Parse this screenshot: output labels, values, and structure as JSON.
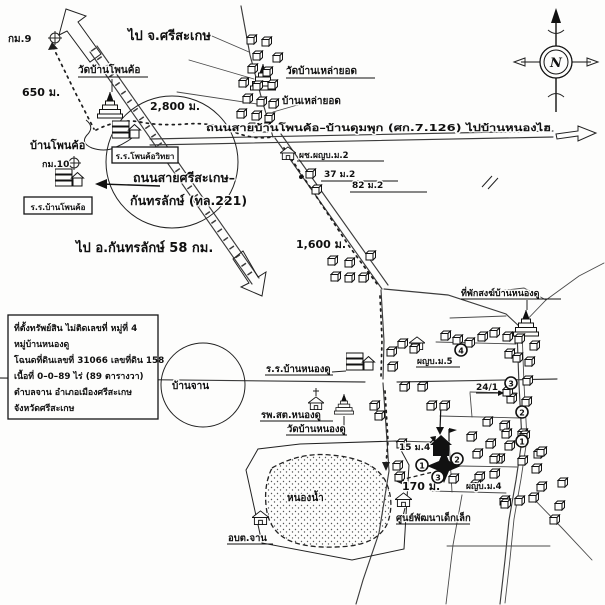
{
  "labels": {
    "to_sisaket": "ไป จ.ศรีสะเกษ",
    "km9": "กม.9",
    "dist_650": "650 ม.",
    "wat_phonkho": "วัดบ้านโพนค้อ",
    "ban_phonkho": "บ้านโพนค้อ",
    "dist_2800": "2,800 ม.",
    "school_phonkho_wittaya": "ร.ร.โพนค้อวิทยา",
    "km10": "กม.10",
    "school_ban_phonkho": "ร.ร.บ้านโพนค้อ",
    "road_221_line1": "ถนนสายศรีสะเกษ–",
    "road_221_line2": "กันทรลักษ์ (ทล.221)",
    "to_kantharalak": "ไป อ.กันทรลักษ์ 58 กม.",
    "wat_laoyot": "วัดบ้านเหล่ายอด",
    "ban_laoyot": "บ้านเหล่ายอด",
    "road_sor_kor": "ถนนสายบ้านโพนค้อ–บ้านดุมพุก (ศก.7.126) ไปบ้านหนองไฮ",
    "asst_headman_m2": "ผช.ผญบ.ม.2",
    "house_37": "37 ม.2",
    "house_82": "82 ม.2",
    "dist_1600": "1,600 ม.",
    "monk_residence": "ที่พักสงฆ์บ้านหนองดู",
    "headman_m5": "ผญบ.ม.5",
    "school_nongdu": "ร.ร.บ้านหนองดู",
    "health_station": "รพ.สต.หนองดู",
    "wat_nongdu": "วัดบ้านหนองดู",
    "ban_chan": "บ้านจาน",
    "house_24_1": "24/1",
    "house_15_m4": "15 ม.4",
    "dist_170": "170 ม.",
    "headman_m4": "ผญบ.ม.4",
    "child_dev_center": "ศูนย์พัฒนาเด็กเล็ก",
    "pond": "หนองน้ำ",
    "sao_chan": "อบต.จาน"
  },
  "compass": {
    "north": "N"
  },
  "markers": {
    "road_1": "1",
    "road_2": "2",
    "road_3": "3",
    "road_4": "4",
    "house_1": "1",
    "house_2": "2",
    "house_3": "3"
  },
  "info_box": {
    "lines": [
      "ที่ตั้งทรัพย์สิน ไม่ติดเลขที่ หมู่ที่ 4",
      "หมู่บ้านหนองดู",
      "โฉนดที่ดินเลขที่ 31066 เลขที่ดิน 158",
      "เนื้อที่ 0–0–89 ไร่ (89 ตารางวา)",
      "ตำบลจาน อำเภอเมืองศรีสะเกษ",
      "จังหวัดศรีสะเกษ"
    ]
  }
}
